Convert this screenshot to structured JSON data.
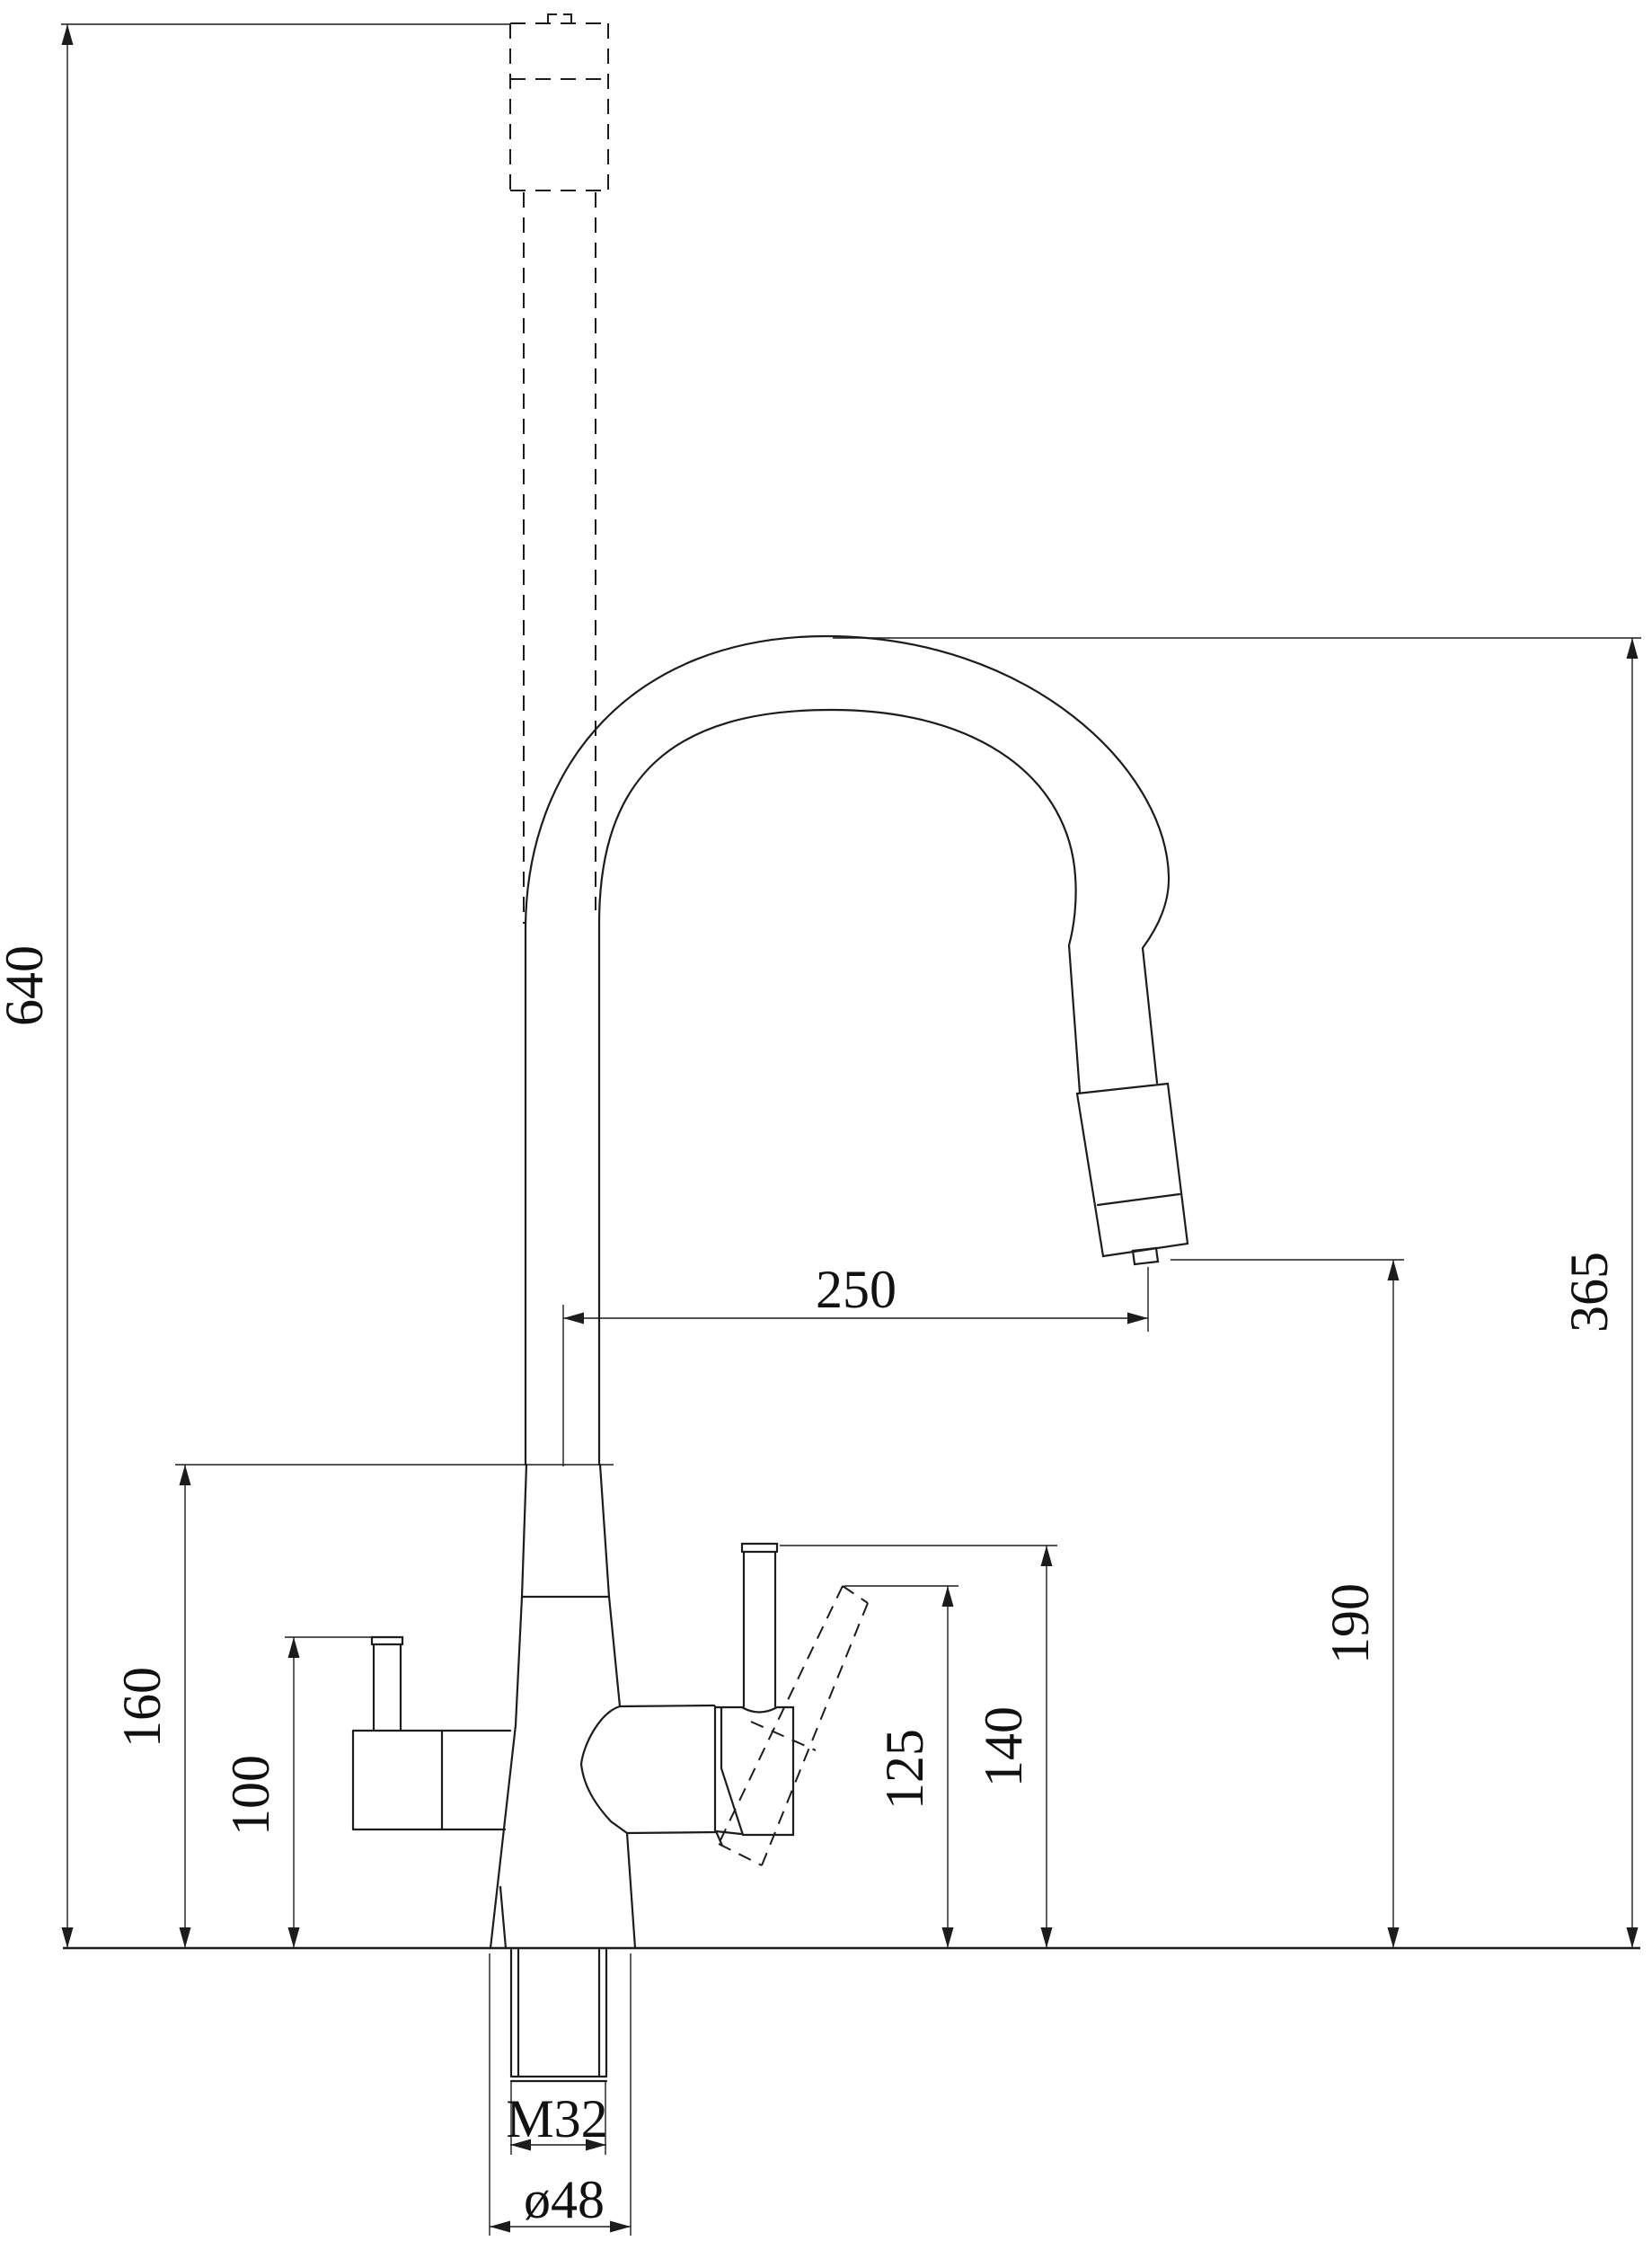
{
  "drawing": {
    "kind": "kitchen-faucet-dimension-drawing",
    "line_color": "#1c1c1c",
    "background": "#ffffff",
    "dimensions": {
      "total_height": "640",
      "spout_reach": "250",
      "spout_outlet_height": "365",
      "outlet_to_deck": "190",
      "body_top_height": "160",
      "side_tube_height": "100",
      "lever_tip_height": "125",
      "lever_top_height": "140",
      "thread_size": "M32",
      "base_diameter": "ø48"
    }
  }
}
